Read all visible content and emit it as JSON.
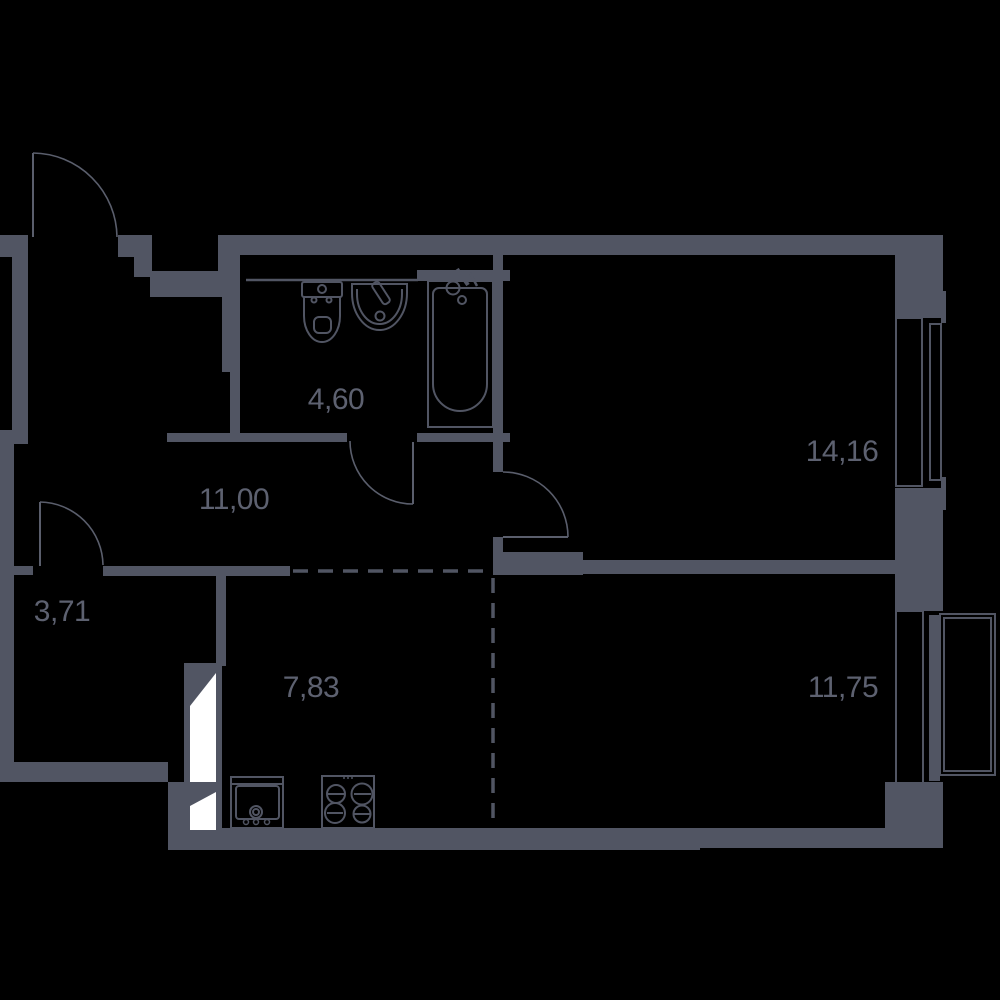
{
  "page": {
    "title": "Apartment floor plan"
  },
  "colors": {
    "background": "#000000",
    "wall": "#515563",
    "fixture": "#515563",
    "door": "#5a5e6c",
    "label": "#5d6170",
    "white": "#ffffff"
  },
  "rooms": [
    {
      "id": "bathroom",
      "area": "4,60"
    },
    {
      "id": "hallway",
      "area": "11,00"
    },
    {
      "id": "storage",
      "area": "3,71"
    },
    {
      "id": "kitchen",
      "area": "7,83"
    },
    {
      "id": "bedroom",
      "area": "14,16"
    },
    {
      "id": "living-room",
      "area": "11,75"
    }
  ]
}
